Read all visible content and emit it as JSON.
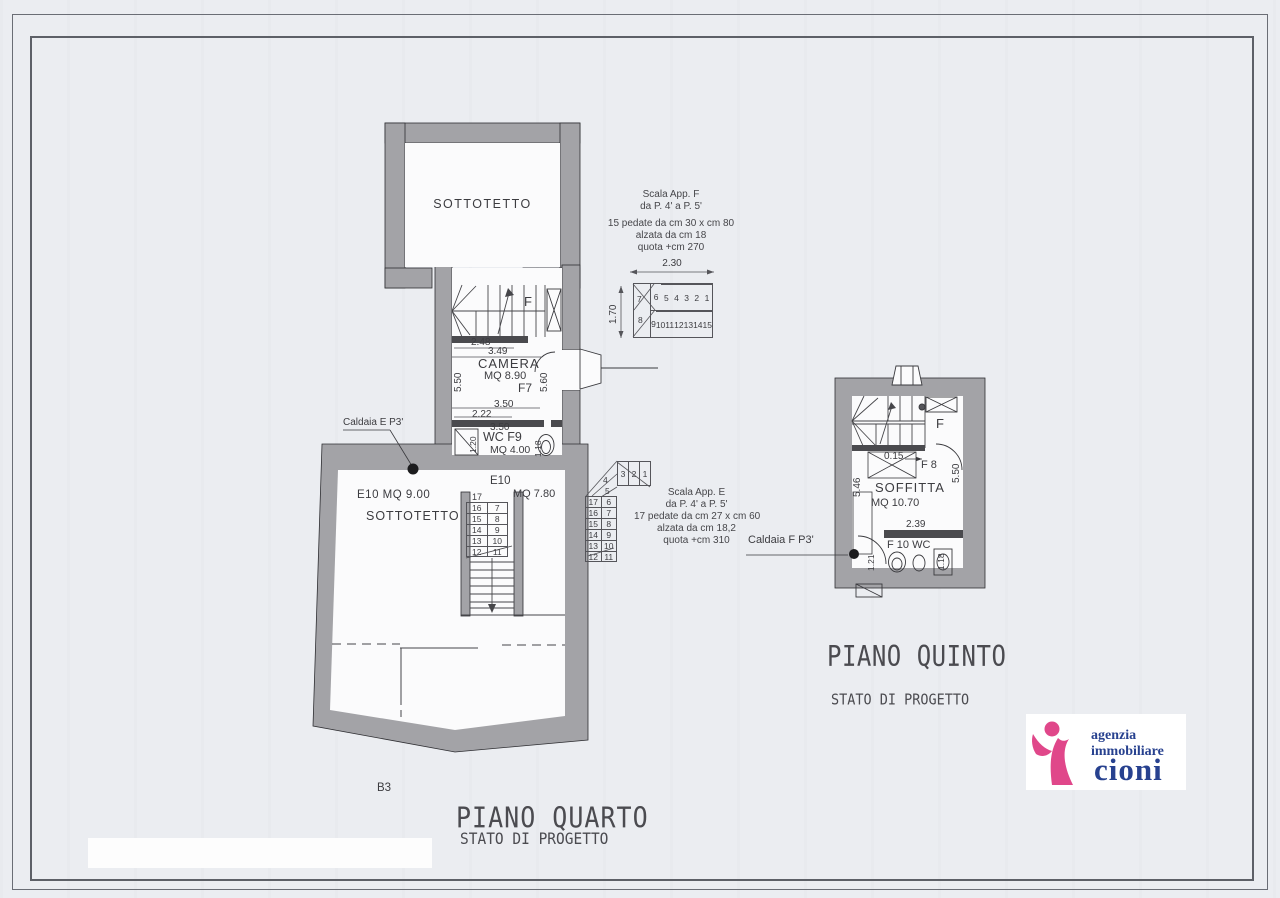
{
  "colors": {
    "wall_gray": "#a3a3a7",
    "wall_dark": "#4a4a4e",
    "line": "#2f2f33",
    "logo_pink": "#e0478a",
    "logo_blue": "#27418f"
  },
  "sheet": {
    "code": "B3",
    "title_quarto": "PIANO QUARTO",
    "subtitle_quarto": "STATO DI PROGETTO",
    "title_quinto": "PIANO QUINTO",
    "subtitle_quinto": "STATO DI PROGETTO"
  },
  "logo": {
    "line1": "agenzia",
    "line2": "immobiliare",
    "line3": "cioni"
  },
  "plan4": {
    "sottotetto_top": "SOTTOTETTO",
    "stair_letter": "F",
    "camera_name": "CAMERA",
    "camera_area": "MQ 8.90",
    "camera_code": "F7",
    "wc_name": "WC F9",
    "wc_area": "MQ 4.00",
    "landing_code": "E10",
    "landing_area": "MQ 7.80",
    "room_code_area": "E10 MQ 9.00",
    "room_name": "SOTTOTETTO",
    "caldaia": "Caldaia E P3'",
    "dims": {
      "d248": "2.48",
      "d349": "3.49",
      "d222": "2.22",
      "d350a": "3.50",
      "d350b": "3.50",
      "d550": "5.50",
      "d560": "5.60",
      "d120": "1.20",
      "d118": "1.18"
    },
    "stair_plan": {
      "top": "17",
      "left": [
        "16",
        "15",
        "14",
        "13",
        "12"
      ],
      "right": [
        "7",
        "8",
        "9",
        "10",
        "11"
      ]
    }
  },
  "plan5": {
    "soffitta_name": "SOFFITTA",
    "soffitta_area": "MQ 10.70",
    "stair_letter": "F",
    "f8": "F 8",
    "wc": "F 10 WC",
    "caldaia": "Caldaia F P3'",
    "dims": {
      "d546": "5.46",
      "d550": "5.50",
      "d015": "0.15",
      "d239": "2.39",
      "d121": "1.21",
      "d118": "1.18"
    }
  },
  "scala_f": {
    "l1": "Scala App. F",
    "l2": "da P. 4' a P. 5'",
    "l3": "15 pedate da cm 30 x cm 80",
    "l4": "alzata da cm 18",
    "l5": "quota +cm 270",
    "dw": "2.30",
    "dh": "1.70",
    "w1": "7",
    "w2": "8",
    "top": [
      "6",
      "5",
      "4",
      "3",
      "2",
      "1"
    ],
    "bottom": [
      "9",
      "10",
      "11",
      "12",
      "13",
      "14",
      "15"
    ]
  },
  "scala_e": {
    "l1": "Scala App. E",
    "l2": "da P. 4' a P. 5'",
    "l3": "17 pedate da cm 27 x cm 60",
    "l4": "alzata da cm 18,2",
    "l5": "quota +cm 310",
    "w1": "4",
    "w2": "5",
    "top": [
      "3",
      "2",
      "1"
    ],
    "left": [
      "17",
      "16",
      "15",
      "14",
      "13",
      "12"
    ],
    "right": [
      "6",
      "7",
      "8",
      "9",
      "10",
      "11"
    ]
  }
}
